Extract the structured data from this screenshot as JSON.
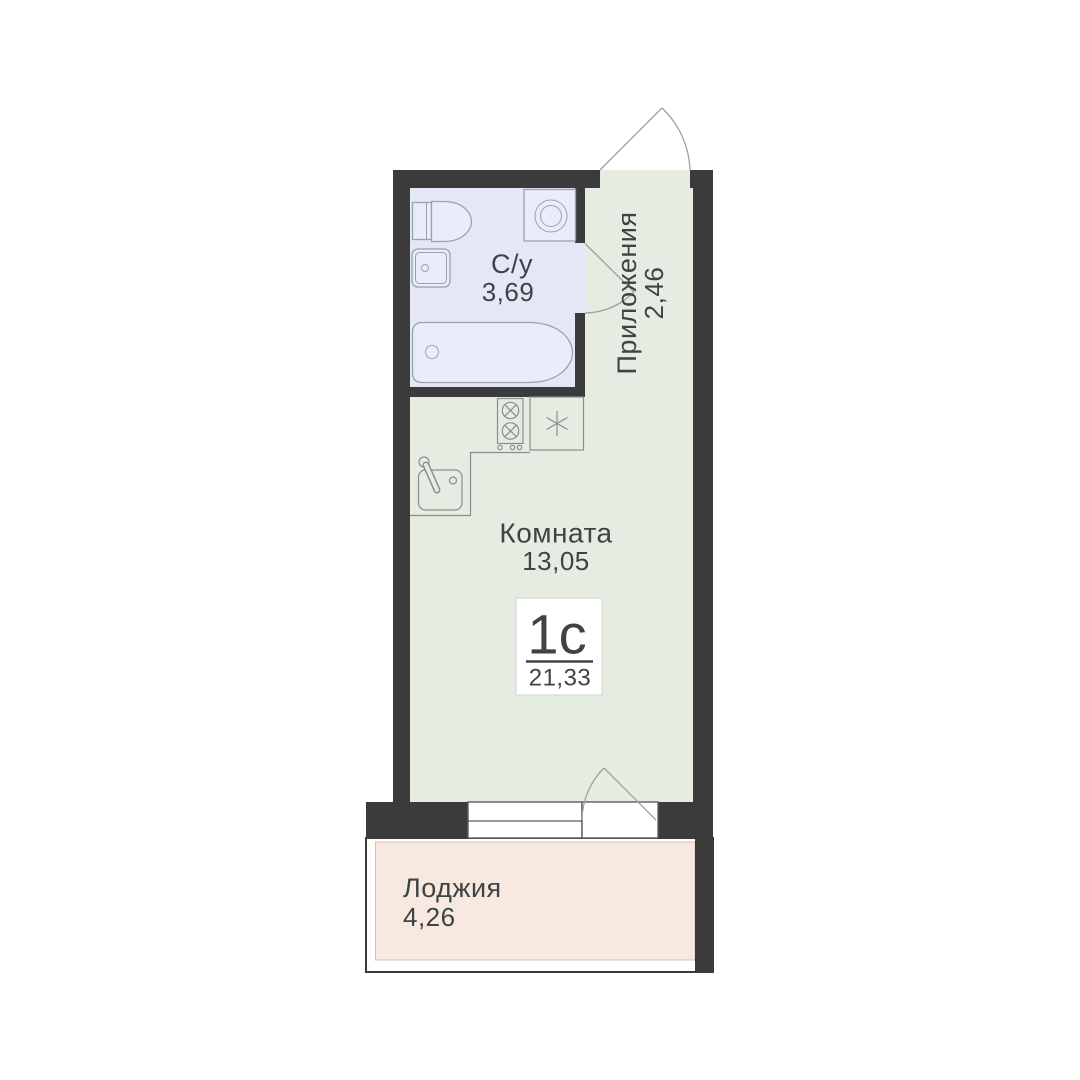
{
  "plan": {
    "title": "Studio apartment floor plan",
    "unit_label": {
      "type": "1с",
      "total_area": "21,33"
    },
    "rooms": [
      {
        "id": "bathroom",
        "name": "С/у",
        "area": "3,69"
      },
      {
        "id": "hallway",
        "name": "Приложения",
        "area": "2,46"
      },
      {
        "id": "room",
        "name": "Комната",
        "area": "13,05"
      },
      {
        "id": "loggia",
        "name": "Лоджия",
        "area": "4,26"
      }
    ],
    "icons": [
      "toilet-icon",
      "bathroom-sink-icon",
      "washing-machine-icon",
      "bathtub-icon",
      "stove-icon",
      "fridge-snowflake-icon",
      "kitchen-sink-icon",
      "entrance-door-swing-icon",
      "bathroom-door-swing-icon",
      "balcony-door-swing-icon",
      "window-icon"
    ]
  },
  "colors": {
    "wall": "#3b3b3c",
    "floor_room": "#e5ece2",
    "floor_bath": "#e4e7f5",
    "floor_loggia": "#f8e9e0",
    "loggia_border": "#d2c1b5",
    "window_line": "#5a5f5c",
    "door_line": "#9aa39c",
    "fixture_bath_fill": "#eaedf9",
    "fixture_bath_stroke": "#98a0b4",
    "fixture_kitchen_stroke": "#87918b",
    "label_box_border": "#d9d9d9",
    "text": "#3e4345"
  }
}
